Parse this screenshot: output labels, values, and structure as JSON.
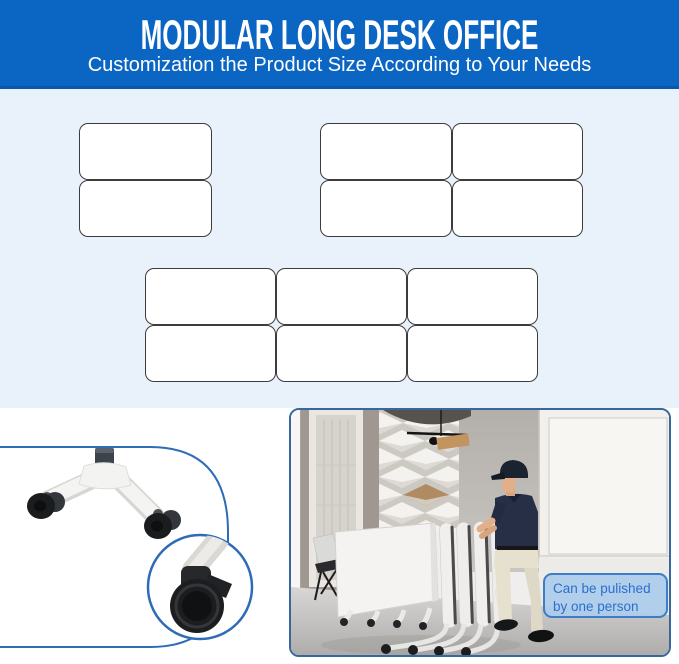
{
  "header": {
    "title": "MODULAR LONG DESK OFFICE",
    "subtitle": "Customization the Product Size According to Your Needs",
    "bg_color": "#0b66c3",
    "text_color": "#ffffff"
  },
  "layout_diagram": {
    "bg_color": "#e9f2fb",
    "desk_fill": "#ffffff",
    "desk_border_color": "#3c3c3c",
    "groups": [
      {
        "name": "two-desk-layout",
        "rows": 2,
        "cols": 1,
        "desk_count": 2
      },
      {
        "name": "four-desk-layout",
        "rows": 2,
        "cols": 2,
        "desk_count": 4
      },
      {
        "name": "six-desk-layout",
        "rows": 2,
        "cols": 3,
        "desk_count": 6
      }
    ]
  },
  "detail_panels": {
    "accent_blue": "#2f6cb7",
    "caster_panel": {
      "content": "desk-leg-with-locking-casters",
      "inset": "caster-wheel-closeup"
    },
    "photo_panel": {
      "content": "person-pushing-folded-flip-top-tables",
      "annotation": {
        "text": "Can be pulished by one person",
        "text_color": "#2b6fce",
        "bg_color": "#abcbea",
        "border_color": "#3f7cc7"
      }
    }
  }
}
